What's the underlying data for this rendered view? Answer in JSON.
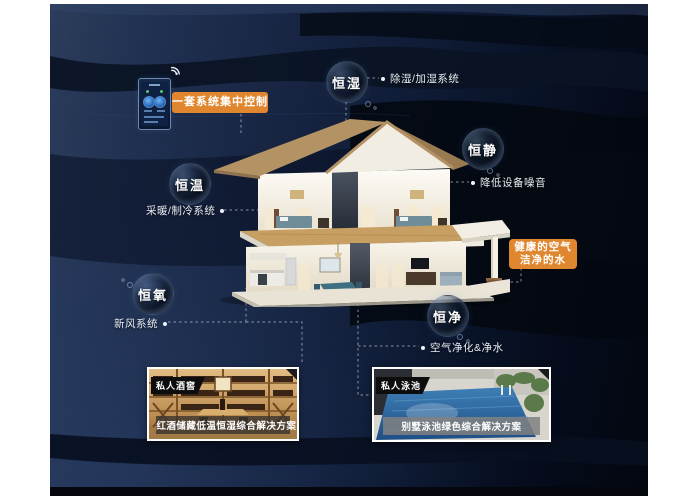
{
  "control_panel": {
    "badge": "一套系统集中控制"
  },
  "features": [
    {
      "name": "恒湿",
      "desc": "除湿/加湿系统"
    },
    {
      "name": "恒静",
      "desc": "降低设备噪音"
    },
    {
      "name": "恒温",
      "desc": "采暖/制冷系统"
    },
    {
      "name": "恒氧",
      "desc": "新风系统"
    },
    {
      "name": "恒净",
      "desc": "空气净化&净水"
    }
  ],
  "highlight": {
    "line1": "健康的空气",
    "line2": "洁净的水"
  },
  "cards": [
    {
      "tag": "私人酒窖",
      "caption": "红酒储藏低温恒湿综合解决方案"
    },
    {
      "tag": "私人泳池",
      "caption": "别墅泳池绿色综合解决方案"
    }
  ],
  "icons": {
    "wifi": "wifi-signal-waves"
  },
  "colors": {
    "accent_orange": "#e0862e",
    "panel_navy": "#16233c",
    "label_text": "#e9eef5",
    "caption_band_wine": "rgba(62,54,46,0.82)",
    "caption_band_pool": "rgba(128,128,128,0.85)"
  }
}
